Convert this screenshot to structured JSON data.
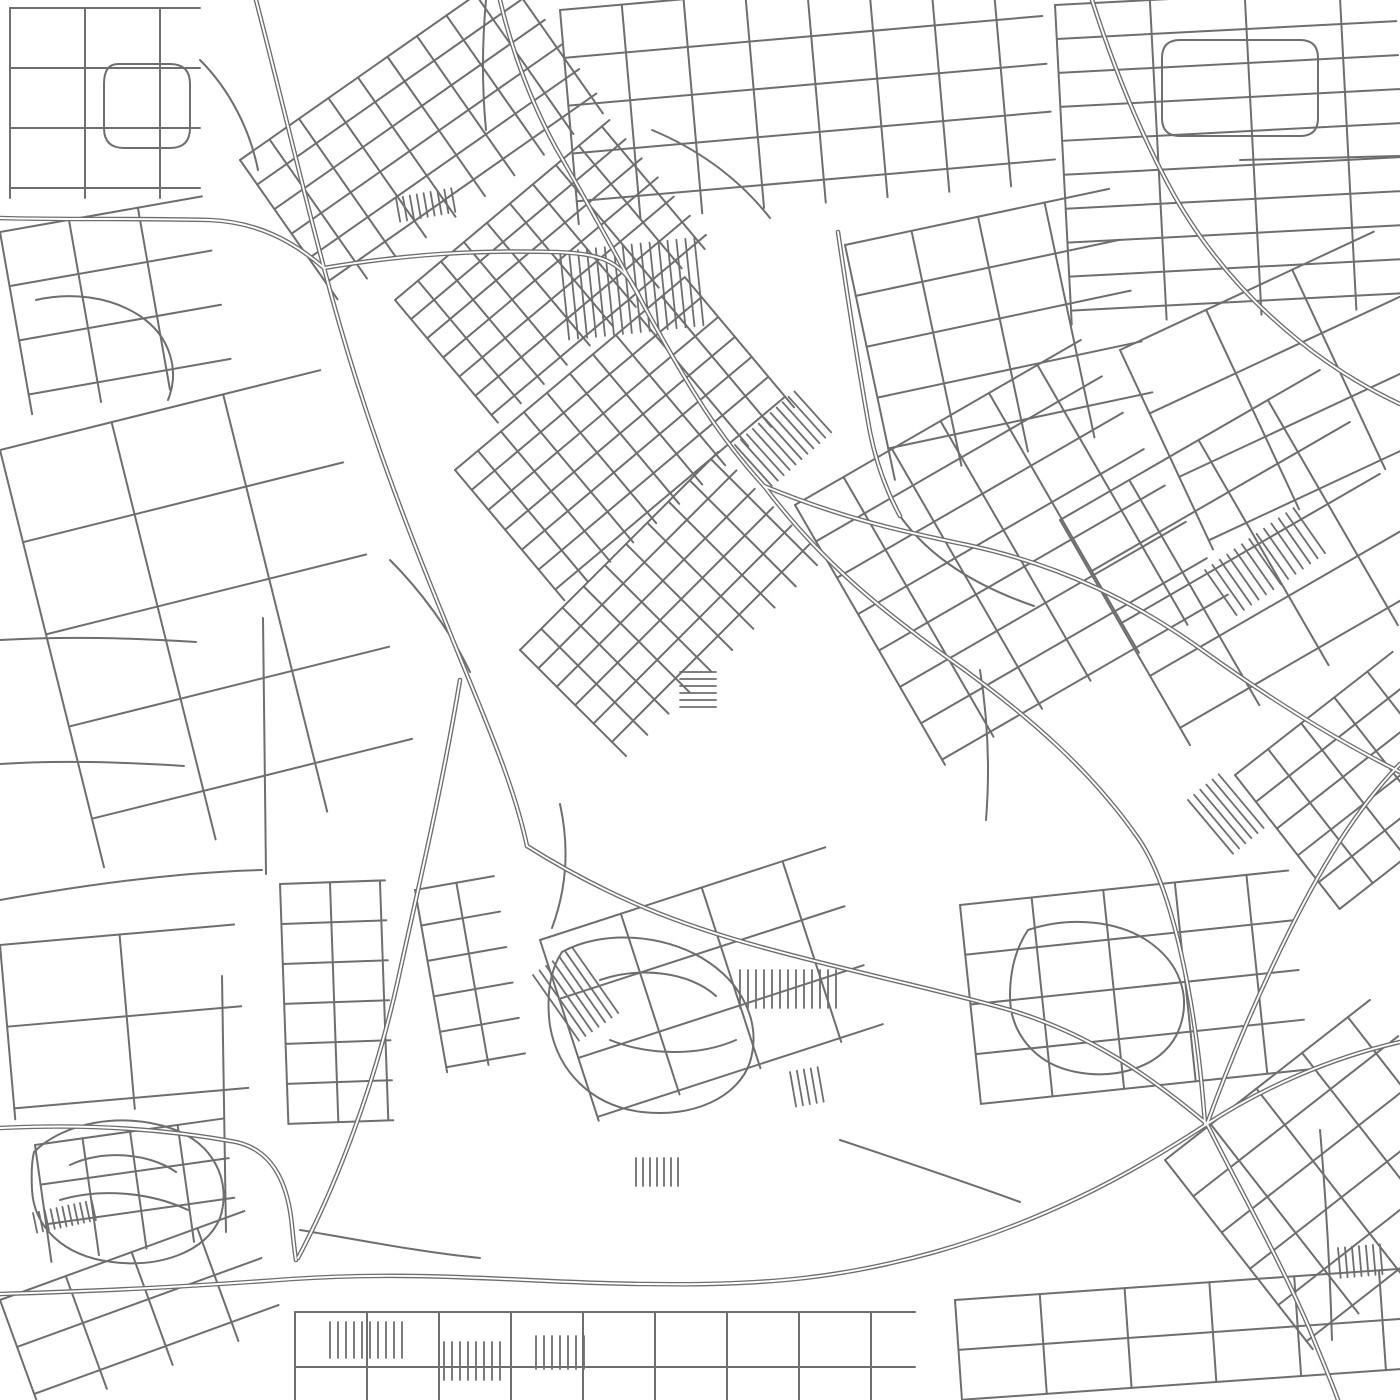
{
  "map": {
    "width": 1400,
    "height": 1400,
    "background": "#ffffff",
    "road_color": "#6e6e6e",
    "stroke_widths": {
      "street": 2,
      "hatch": 1.8,
      "major_outer": 4.6,
      "major_inner": 1.9
    },
    "layers": [
      {
        "name": "field-parcels",
        "type": "grid",
        "width": 2,
        "grids": [
          {
            "x": 0,
            "y": 450,
            "a": -14,
            "w": 330,
            "h": 430,
            "sx": 115,
            "sy": 95
          },
          {
            "x": 0,
            "y": 945,
            "a": -5,
            "w": 235,
            "h": 175,
            "sx": 120,
            "sy": 82
          }
        ]
      },
      {
        "name": "district-street-grids",
        "type": "grid",
        "width": 2,
        "grids": [
          {
            "x": 10,
            "y": 8,
            "a": 0,
            "w": 190,
            "h": 190,
            "sx": 75,
            "sy": 60
          },
          {
            "x": 0,
            "y": 232,
            "a": -10,
            "w": 205,
            "h": 185,
            "sx": 70,
            "sy": 55
          },
          {
            "x": 240,
            "y": 160,
            "a": -35,
            "w": 330,
            "h": 170,
            "sx": 36,
            "sy": 30
          },
          {
            "x": 560,
            "y": 10,
            "a": -5,
            "w": 480,
            "h": 215,
            "sx": 62,
            "sy": 48
          },
          {
            "x": 1055,
            "y": 5,
            "a": -3,
            "w": 340,
            "h": 320,
            "sx": 95,
            "sy": 34
          },
          {
            "x": 395,
            "y": 300,
            "a": -40,
            "w": 280,
            "h": 160,
            "sx": 30,
            "sy": 25
          },
          {
            "x": 455,
            "y": 470,
            "a": -40,
            "w": 300,
            "h": 170,
            "sx": 30,
            "sy": 26
          },
          {
            "x": 520,
            "y": 650,
            "a": -45,
            "w": 280,
            "h": 150,
            "sx": 30,
            "sy": 26
          },
          {
            "x": 845,
            "y": 245,
            "a": -12,
            "w": 270,
            "h": 240,
            "sx": 68,
            "sy": 52
          },
          {
            "x": 795,
            "y": 505,
            "a": -30,
            "w": 330,
            "h": 300,
            "sx": 56,
            "sy": 42
          },
          {
            "x": 1060,
            "y": 520,
            "a": -30,
            "w": 300,
            "h": 260,
            "sx": 80,
            "sy": 60
          },
          {
            "x": 1120,
            "y": 350,
            "a": -25,
            "w": 280,
            "h": 220,
            "sx": 95,
            "sy": 70
          },
          {
            "x": 1235,
            "y": 775,
            "a": -38,
            "w": 200,
            "h": 170,
            "sx": 42,
            "sy": 34
          },
          {
            "x": 960,
            "y": 905,
            "a": -6,
            "w": 330,
            "h": 200,
            "sx": 72,
            "sy": 50
          },
          {
            "x": 1165,
            "y": 1160,
            "a": -38,
            "w": 260,
            "h": 240,
            "sx": 58,
            "sy": 46
          },
          {
            "x": 280,
            "y": 884,
            "a": -2,
            "w": 105,
            "h": 240,
            "sx": 50,
            "sy": 40
          },
          {
            "x": 415,
            "y": 890,
            "a": -10,
            "w": 80,
            "h": 185,
            "sx": 42,
            "sy": 36
          },
          {
            "x": 540,
            "y": 940,
            "a": -18,
            "w": 300,
            "h": 190,
            "sx": 85,
            "sy": 62
          },
          {
            "x": 295,
            "y": 1312,
            "a": 0,
            "w": 620,
            "h": 90,
            "sx": 72,
            "sy": 55
          },
          {
            "x": 955,
            "y": 1300,
            "a": -4,
            "w": 450,
            "h": 100,
            "sx": 85,
            "sy": 50
          },
          {
            "x": 0,
            "y": 1300,
            "a": -20,
            "w": 260,
            "h": 120,
            "sx": 70,
            "sy": 50
          },
          {
            "x": 35,
            "y": 1145,
            "a": -8,
            "w": 190,
            "h": 118,
            "sx": 48,
            "sy": 40
          }
        ]
      },
      {
        "name": "hatched-blocks",
        "type": "grid",
        "width": 1.8,
        "grids": [
          {
            "x": 560,
            "y": 252,
            "a": -6,
            "w": 135,
            "h": 88,
            "sx": 9,
            "sy": 0
          },
          {
            "x": 735,
            "y": 445,
            "a": -42,
            "w": 85,
            "h": 55,
            "sx": 8,
            "sy": 0
          },
          {
            "x": 680,
            "y": 672,
            "a": 0,
            "w": 36,
            "h": 40,
            "sx": 0,
            "sy": 7
          },
          {
            "x": 1205,
            "y": 570,
            "a": -35,
            "w": 110,
            "h": 55,
            "sx": 9,
            "sy": 0
          },
          {
            "x": 396,
            "y": 198,
            "a": -10,
            "w": 60,
            "h": 24,
            "sx": 7,
            "sy": 0
          },
          {
            "x": 533,
            "y": 975,
            "a": -35,
            "w": 55,
            "h": 80,
            "sx": 8,
            "sy": 0
          },
          {
            "x": 740,
            "y": 970,
            "a": 0,
            "w": 98,
            "h": 38,
            "sx": 8,
            "sy": 0
          },
          {
            "x": 636,
            "y": 1158,
            "a": 0,
            "w": 45,
            "h": 28,
            "sx": 7,
            "sy": 0
          },
          {
            "x": 330,
            "y": 1322,
            "a": 0,
            "w": 75,
            "h": 36,
            "sx": 8,
            "sy": 0
          },
          {
            "x": 444,
            "y": 1342,
            "a": 0,
            "w": 58,
            "h": 38,
            "sx": 8,
            "sy": 0
          },
          {
            "x": 536,
            "y": 1336,
            "a": 0,
            "w": 55,
            "h": 33,
            "sx": 8,
            "sy": 0
          },
          {
            "x": 33,
            "y": 1213,
            "a": -12,
            "w": 60,
            "h": 20,
            "sx": 6,
            "sy": 0
          },
          {
            "x": 1338,
            "y": 1248,
            "a": -5,
            "w": 48,
            "h": 30,
            "sx": 7,
            "sy": 0
          },
          {
            "x": 790,
            "y": 1072,
            "a": -10,
            "w": 30,
            "h": 35,
            "sx": 7,
            "sy": 0
          },
          {
            "x": 1188,
            "y": 800,
            "a": -40,
            "w": 45,
            "h": 70,
            "sx": 8,
            "sy": 0
          }
        ]
      },
      {
        "name": "minor-roads",
        "type": "paths",
        "width": 2,
        "paths": [
          "M118,64 h52 q20,0 20,20 v44 q0,20 -20,20 h-46 q-20,0 -20,-20 v-44 q0,-20 14,-20 Z",
          "M36,300 C70,292 110,296 140,316 C170,336 180,370 168,400",
          "M200,60 C230,90 250,130 258,170",
          "M0,640 C70,636 130,638 196,642",
          "M0,764 C60,760 120,762 184,766",
          "M0,900 C90,884 180,872 262,870",
          "M263,618 L266,874",
          "M222,976 L226,1232",
          "M34,1152 C64,1122 122,1112 170,1128 C214,1142 232,1182 220,1218 C206,1252 160,1268 112,1262 C62,1256 34,1226 32,1190 C31,1170 32,1160 34,1152 Z",
          "M70,1165 C100,1150 148,1152 176,1172",
          "M60,1200 C100,1188 150,1192 188,1210",
          "M562,952 C602,930 662,934 702,958 C742,982 762,1022 750,1062 C738,1098 692,1118 642,1112 C592,1106 558,1072 550,1026 C546,996 550,970 562,952 Z",
          "M600,980 C640,966 690,972 716,996",
          "M610,1040 C650,1056 700,1056 736,1040",
          "M560,804 C570,850 566,890 552,928",
          "M1028,930 C1070,916 1120,920 1152,944 C1184,968 1192,1004 1176,1036 C1160,1066 1118,1080 1076,1072 C1034,1064 1010,1032 1010,996 C1010,970 1016,948 1028,930 Z",
          "M900,516 C930,558 976,586 1034,606",
          "M980,670 C988,720 990,770 986,820",
          "M1180,40 h120 q18,0 18,18 v60 q0,18 -18,18 h-120 q-18,0 -18,-18 v-60 q0,-18 18,-18 Z",
          "M1240,160 L1400,156",
          "M300,1230 C360,1240 420,1252 480,1258",
          "M840,1140 C900,1160 960,1180 1020,1202",
          "M1320,1130 C1326,1200 1330,1270 1332,1340",
          "M486,0 C482,44 482,88 486,130",
          "M652,130 C700,150 740,180 770,218",
          "M390,560 C420,590 450,630 470,672"
        ]
      },
      {
        "name": "major-roads",
        "type": "paths",
        "width": 4.6,
        "double": true,
        "inner": 1.9,
        "paths": [
          "M256,0 C282,100 298,170 324,268 C358,398 398,506 444,618 C478,704 512,776 527,846",
          "M460,680 C442,788 420,880 398,980 C374,1088 336,1186 298,1258",
          "M0,1294 C130,1290 210,1285 292,1279 C430,1270 530,1283 645,1284 C770,1286 845,1277 935,1252 C1040,1222 1125,1178 1207,1124 C1262,1088 1330,1058 1400,1042",
          "M527,846 C610,898 680,925 765,948 C860,974 940,990 1010,1010 C1090,1034 1150,1076 1207,1124",
          "M642,302 C690,390 720,438 764,486",
          "M764,486 C846,520 906,532 972,546 C1062,566 1136,602 1205,652 C1272,700 1340,742 1400,772",
          "M764,486 C820,560 876,606 948,658 C1030,716 1092,772 1138,838 C1172,886 1196,1000 1205,1124",
          "M642,302 C612,248 584,196 556,148 C532,104 512,52 500,0",
          "M324,268 C408,254 474,250 556,252 C606,254 624,262 642,302",
          "M0,218 C70,220 140,218 210,220 C256,222 292,240 324,268",
          "M1207,1124 C1240,1190 1280,1260 1310,1330 C1320,1355 1330,1378 1338,1400",
          "M1207,1124 C1230,1060 1260,990 1290,930 C1320,870 1355,810 1400,764",
          "M1092,0 C1112,62 1136,124 1168,184 C1202,248 1246,298 1298,340 C1330,366 1366,388 1400,404",
          "M838,232 C848,300 858,366 870,432 C876,462 886,490 900,516",
          "M0,1128 C80,1124 160,1128 236,1142 C272,1150 288,1182 292,1226 C294,1246 295,1254 296,1260"
        ]
      }
    ]
  }
}
